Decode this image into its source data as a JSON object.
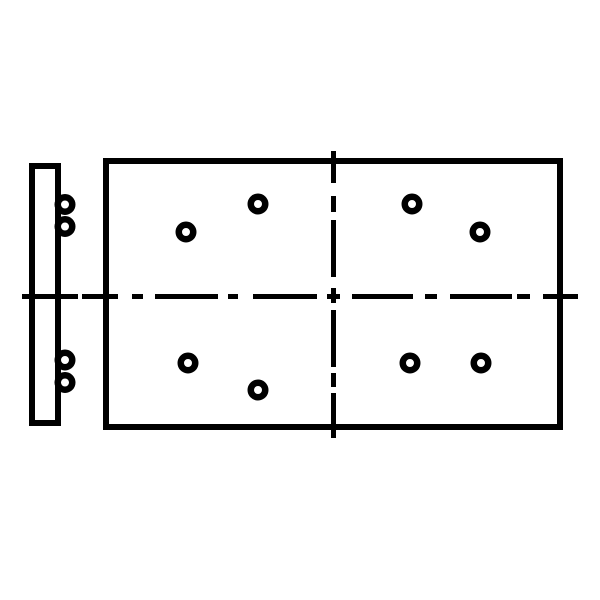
{
  "canvas": {
    "width": 600,
    "height": 600,
    "background": "#ffffff",
    "line_color": "#000000"
  },
  "drawing": {
    "kind": "technical-package-outline-drawing",
    "description": "Rectangular package body with eight round holes, left-side terminal strip with four bump terminals, and dash-dot horizontal and vertical centerlines",
    "body_rect": {
      "x": 103,
      "y": 158,
      "width": 460,
      "height": 272,
      "stroke_width": 6
    },
    "side_rect": {
      "x": 29,
      "y": 163,
      "width": 32,
      "height": 263,
      "stroke_width": 6
    },
    "terminal_bumps": {
      "cx": 65,
      "r": 7.25,
      "stroke_width": 6.5,
      "cys": [
        204.5,
        226.5,
        360,
        382.5
      ]
    },
    "holes": {
      "r": 7.25,
      "stroke_width": 6.5,
      "centers": [
        [
          186,
          232
        ],
        [
          258,
          204
        ],
        [
          412,
          204
        ],
        [
          480,
          232
        ],
        [
          188,
          363
        ],
        [
          258,
          390
        ],
        [
          410,
          363
        ],
        [
          481,
          363
        ]
      ]
    },
    "centerlines": {
      "stroke_width": 5,
      "horizontal": {
        "y": 296.5,
        "segments": [
          [
            22,
            78
          ],
          [
            82,
            118
          ],
          [
            132,
            143
          ],
          [
            155,
            218
          ],
          [
            228,
            238
          ],
          [
            253,
            317
          ],
          [
            327,
            340
          ],
          [
            352,
            413
          ],
          [
            425,
            437
          ],
          [
            450,
            512
          ],
          [
            517,
            530
          ],
          [
            543,
            578
          ]
        ]
      },
      "vertical": {
        "x": 333.5,
        "segments": [
          [
            151,
            183
          ],
          [
            196,
            212
          ],
          [
            220,
            277
          ],
          [
            288,
            303
          ],
          [
            310,
            367
          ],
          [
            373,
            387
          ],
          [
            393,
            438
          ]
        ]
      }
    }
  }
}
